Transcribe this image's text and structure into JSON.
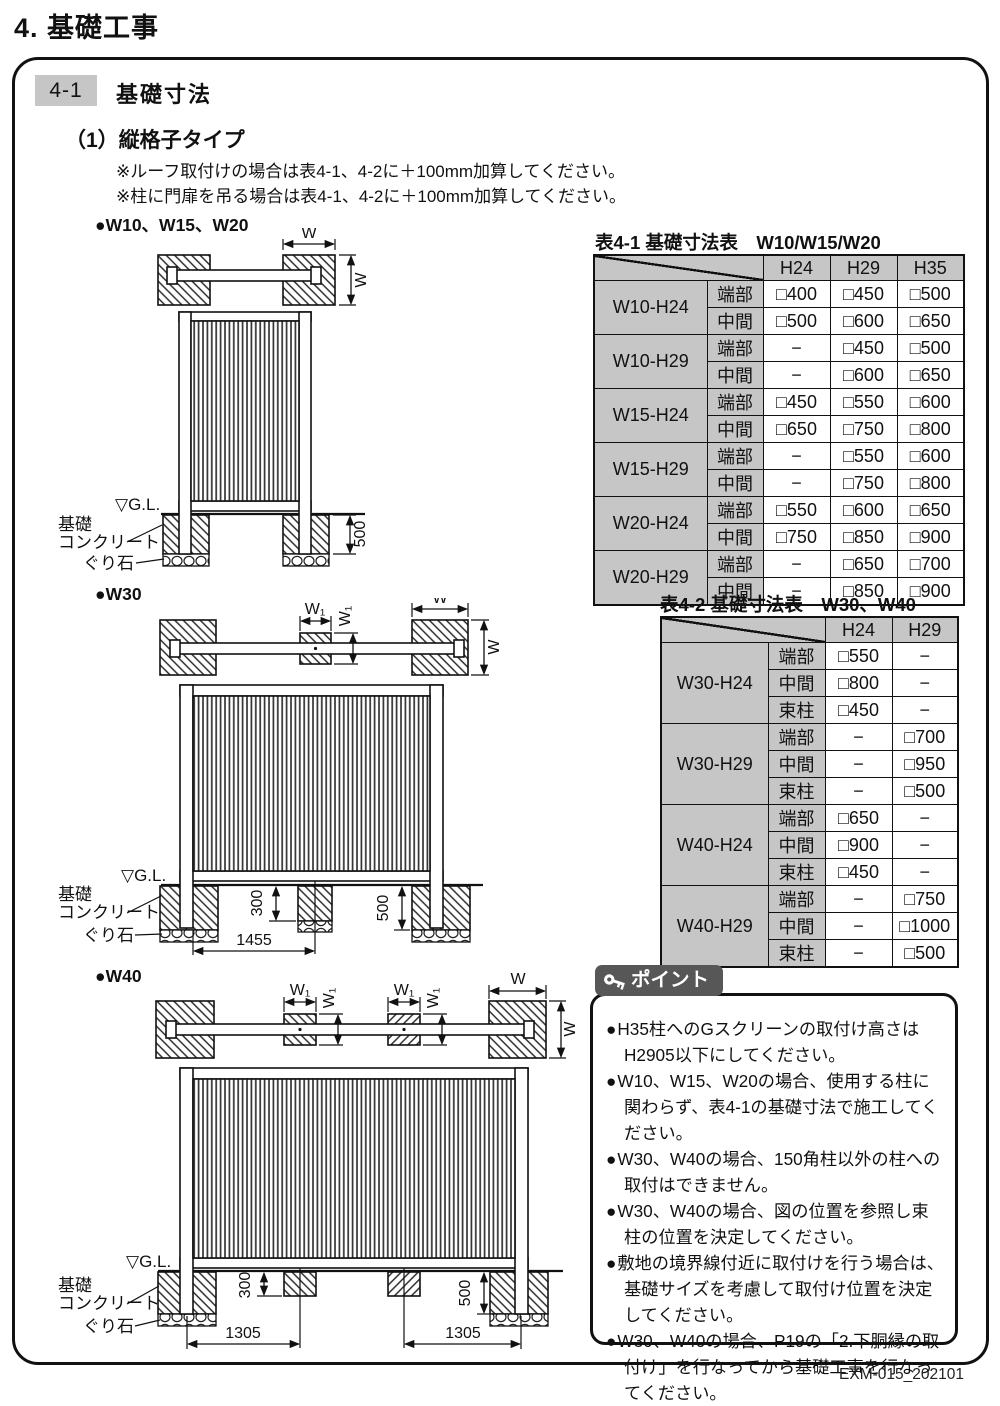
{
  "page": {
    "title": "4. 基礎工事",
    "section_number": "4-1",
    "section_title": "基礎寸法",
    "subsection": "（1）縦格子タイプ",
    "notes": [
      "※ルーフ取付けの場合は表4-1、4-2に＋100mm加算してください。",
      "※柱に門扉を吊る場合は表4-1、4-2に＋100mm加算してください。"
    ],
    "footer": "EXM-015_202101"
  },
  "colors": {
    "header-gray": "#c6c6c6",
    "badge-gray": "#575757",
    "line-black": "#111111"
  },
  "diagram1": {
    "label": "●W10、W15、W20",
    "dim_w": "W",
    "depth_side": "500",
    "gl": "▽G.L.",
    "foundation_line1": "基礎",
    "foundation_line2": "コンクリート",
    "gravel": "ぐり石"
  },
  "diagram2": {
    "label": "●W30",
    "dim_w": "W",
    "dim_w1": "W₁",
    "depth_mid": "300",
    "depth_side": "500",
    "span": "1455",
    "gl": "▽G.L.",
    "foundation_line1": "基礎",
    "foundation_line2": "コンクリート",
    "gravel": "ぐり石"
  },
  "diagram3": {
    "label": "●W40",
    "dim_w": "W",
    "dim_w1": "W₁",
    "depth_mid": "300",
    "depth_side": "500",
    "span1": "1305",
    "span2": "1305",
    "gl": "▽G.L.",
    "foundation_line1": "基礎",
    "foundation_line2": "コンクリート",
    "gravel": "ぐり石"
  },
  "table1": {
    "title": "表4-1 基礎寸法表　W10/W15/W20",
    "col_headers": [
      "H24",
      "H29",
      "H35"
    ],
    "groups": [
      {
        "label": "W10-H24",
        "rows": [
          [
            "端部",
            "□400",
            "□450",
            "□500"
          ],
          [
            "中間",
            "□500",
            "□600",
            "□650"
          ]
        ]
      },
      {
        "label": "W10-H29",
        "rows": [
          [
            "端部",
            "−",
            "□450",
            "□500"
          ],
          [
            "中間",
            "−",
            "□600",
            "□650"
          ]
        ]
      },
      {
        "label": "W15-H24",
        "rows": [
          [
            "端部",
            "□450",
            "□550",
            "□600"
          ],
          [
            "中間",
            "□650",
            "□750",
            "□800"
          ]
        ]
      },
      {
        "label": "W15-H29",
        "rows": [
          [
            "端部",
            "−",
            "□550",
            "□600"
          ],
          [
            "中間",
            "−",
            "□750",
            "□800"
          ]
        ]
      },
      {
        "label": "W20-H24",
        "rows": [
          [
            "端部",
            "□550",
            "□600",
            "□650"
          ],
          [
            "中間",
            "□750",
            "□850",
            "□900"
          ]
        ]
      },
      {
        "label": "W20-H29",
        "rows": [
          [
            "端部",
            "−",
            "□650",
            "□700"
          ],
          [
            "中間",
            "−",
            "□850",
            "□900"
          ]
        ]
      }
    ]
  },
  "table2": {
    "title": "表4-2 基礎寸法表　W30、W40",
    "col_headers": [
      "H24",
      "H29"
    ],
    "groups": [
      {
        "label": "W30-H24",
        "rows": [
          [
            "端部",
            "□550",
            "−"
          ],
          [
            "中間",
            "□800",
            "−"
          ],
          [
            "束柱",
            "□450",
            "−"
          ]
        ]
      },
      {
        "label": "W30-H29",
        "rows": [
          [
            "端部",
            "−",
            "□700"
          ],
          [
            "中間",
            "−",
            "□950"
          ],
          [
            "束柱",
            "−",
            "□500"
          ]
        ]
      },
      {
        "label": "W40-H24",
        "rows": [
          [
            "端部",
            "□650",
            "−"
          ],
          [
            "中間",
            "□900",
            "−"
          ],
          [
            "束柱",
            "□450",
            "−"
          ]
        ]
      },
      {
        "label": "W40-H29",
        "rows": [
          [
            "端部",
            "−",
            "□750"
          ],
          [
            "中間",
            "−",
            "□1000"
          ],
          [
            "束柱",
            "−",
            "□500"
          ]
        ]
      }
    ]
  },
  "points": {
    "header": "ポイント",
    "bullet": "●",
    "items": [
      "H35柱へのGスクリーンの取付け高さはH2905以下にしてください。",
      "W10、W15、W20の場合、使用する柱に関わらず、表4-1の基礎寸法で施工してください。",
      "W30、W40の場合、150角柱以外の柱への取付はできません。",
      "W30、W40の場合、図の位置を参照し束柱の位置を決定してください。",
      "敷地の境界線付近に取付けを行う場合は、基礎サイズを考慮して取付け位置を決定してください。",
      "W30、W40の場合、P19の「2.下胴縁の取付け」を行なってから基礎工事を行なってください。"
    ]
  }
}
